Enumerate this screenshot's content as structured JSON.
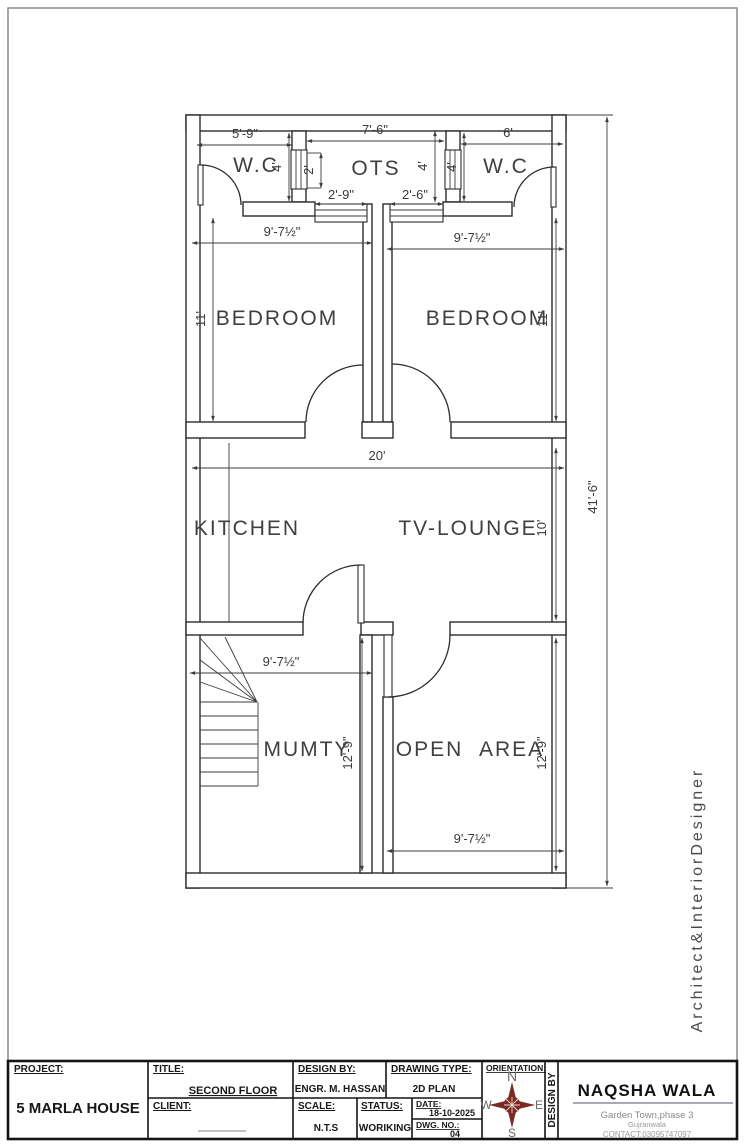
{
  "plan": {
    "rooms": {
      "wc_left": "W.C",
      "ots": "OTS",
      "wc_right": "W.C",
      "bedroom_left": "BEDROOM",
      "bedroom_right": "BEDROOM",
      "kitchen": "KITCHEN",
      "tv_lounge": "TV-LOUNGE",
      "mumty": "MUMTY",
      "open_area": "OPEN AREA"
    },
    "dims": {
      "wc_left_w": "5'-9\"",
      "ots_w": "7'-6\"",
      "wc_right_w": "6'",
      "wc_left_d": "4'",
      "ots_shaft": "2'",
      "ots_d": "4'",
      "wc_right_d": "4'",
      "ots_win_left": "2'-9\"",
      "ots_win_right": "2'-6\"",
      "bedroom_left_w": "9'-7½\"",
      "bedroom_right_w": "9'-7½\"",
      "bedroom_left_d": "11'",
      "bedroom_right_d": "11'",
      "lounge_w": "20'",
      "lounge_d": "10'",
      "mumty_w": "9'-7½\"",
      "mumty_d": "12'-9\"",
      "open_area_d": "12'-9\"",
      "open_area_w": "9'-7½\"",
      "overall_d": "41'-6\""
    },
    "branding_vertical": "Architect&InteriorDesigner"
  },
  "titleblock": {
    "project_label": "PROJECT:",
    "project": "5 MARLA HOUSE",
    "title_label": "TITLE:",
    "title": "SECOND FLOOR",
    "client_label": "CLIENT:",
    "design_by_label": "DESIGN BY:",
    "design_by": "ENGR. M. HASSAN",
    "drawing_type_label": "DRAWING TYPE:",
    "drawing_type": "2D PLAN",
    "scale_label": "SCALE:",
    "scale": "N.T.S",
    "status_label": "STATUS:",
    "status": "WORIKING",
    "date_label": "DATE:",
    "date": "18-10-2025",
    "dwg_label": "DWG. NO.:",
    "dwg_no": "04",
    "orientation_label": "ORIENTATION:",
    "compass": {
      "n": "N",
      "e": "E",
      "s": "S",
      "w": "W"
    },
    "design_by_vertical": "DESIGN BY",
    "firm": {
      "name": "NAQSHA WALA",
      "line1": "Garden Town,phase 3",
      "line2": "Gujranwala",
      "contact": "CONTACT:03095747097"
    }
  },
  "colors": {
    "compass": "#7b2a21"
  }
}
